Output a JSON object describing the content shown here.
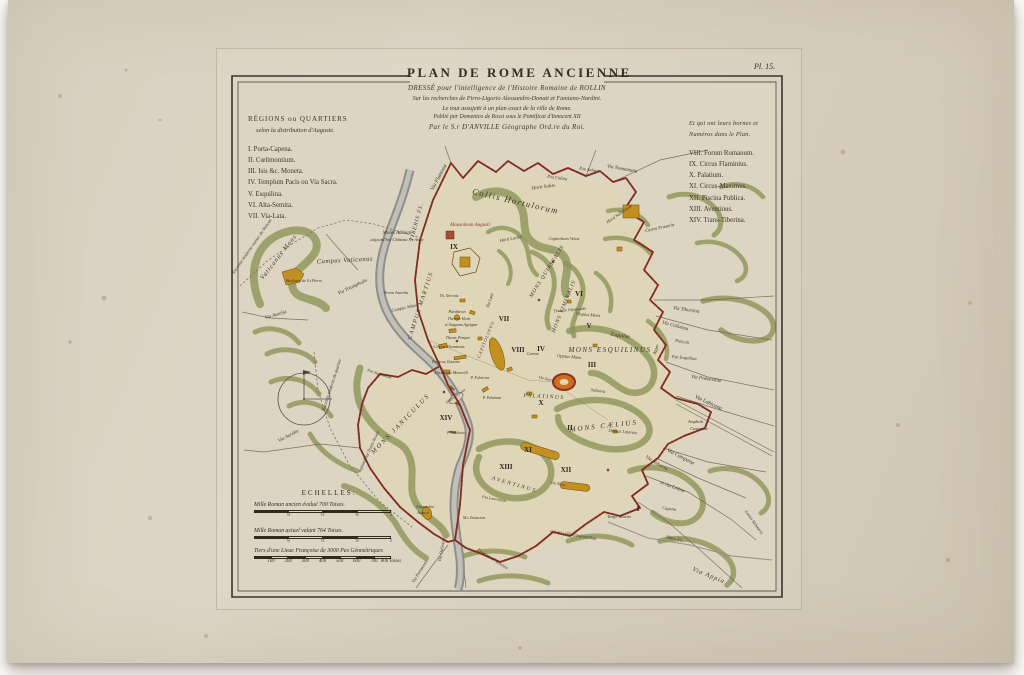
{
  "plate_label": "Pl. 15.",
  "title_block": {
    "title": "PLAN DE ROME ANCIENNE",
    "line1": "DRESSÉ pour l'intelligence de l'Histoire Romaine de ROLLIN",
    "line2": "Sur les recherches de Pirro-Ligorio Alessandro-Donati et Famiano-Nardini.",
    "line3": "Le tout assujetti à un plan exact de la ville de Rome.",
    "line4": "Publié par Domenico de Rossi sous le Pontificat d'Innocent XII",
    "line5": "Par le S.r D'ANVILLE Géographe Ord.re du Roi."
  },
  "legend_left": {
    "heading1": "RÉGIONS ou QUARTIERS",
    "heading2": "selon la distribution d'Auguste.",
    "items": [
      "I. Porta-Capena.",
      "II. Cœlimontium.",
      "III. Isis &c. Moneta.",
      "IV. Templum Pacis ou Via Sacra.",
      "V. Esquilina.",
      "VI. Alta-Semita.",
      "VII. Via-Lata."
    ]
  },
  "legend_right": {
    "heading1": "Et qui ont leurs bornes et",
    "heading2": "Numéros dans le Plan.",
    "items": [
      "VIII. Forum Romanum.",
      "IX. Circus Flaminius.",
      "X. Palatium.",
      "XI. Circus-Maximus.",
      "XII. Piscina Publica.",
      "XIII. Aventinus.",
      "XIV. Trans-Tiberina."
    ]
  },
  "scales": {
    "heading": "ECHELLES.",
    "bars": [
      {
        "label": "Mille Roman ancien évalué 700 Toises.",
        "ticks": [
          "¼",
          "½",
          "¾",
          "1"
        ]
      },
      {
        "label": "Mille Roman actuel valant 764 Toises.",
        "ticks": [
          "¼",
          "½",
          "¾",
          "1"
        ]
      },
      {
        "label": "Tiers d'une Lieue Françoise de 3000 Pas Géométriques",
        "ticks": [
          "100",
          "200",
          "300",
          "400",
          "500",
          "600",
          "700",
          "800 Toises"
        ]
      }
    ]
  },
  "colors": {
    "wall": "#832d20",
    "river": "#8f8e89",
    "hill": "#8b9454",
    "building": "#c2901f",
    "paper": "#d8d0bf",
    "ink": "#342f27"
  },
  "map_labels": [
    {
      "t": "Via Flaminia",
      "x": 432,
      "y": 178,
      "r": -62,
      "s": 5.5
    },
    {
      "t": "Horti Salus.",
      "x": 536,
      "y": 188,
      "r": -8,
      "s": 5
    },
    {
      "t": "P.ta Colina",
      "x": 549,
      "y": 179,
      "r": 8,
      "s": 4.5
    },
    {
      "t": "P.ta Salara",
      "x": 581,
      "y": 171,
      "r": 8,
      "s": 4.5
    },
    {
      "t": "Via Nomentana",
      "x": 614,
      "y": 170,
      "r": 10,
      "s": 5
    },
    {
      "t": "Collis Hortulorum",
      "x": 507,
      "y": 204,
      "r": 13,
      "s": 8.5,
      "c": "C",
      "ls": 1.5
    },
    {
      "t": "Mausoleum Augusti",
      "x": 462,
      "y": 226,
      "r": 0,
      "s": 5,
      "c": "red"
    },
    {
      "t": "IX",
      "x": 446,
      "y": 249,
      "s": 7,
      "c": "n"
    },
    {
      "t": "Moles Adriani",
      "x": 389,
      "y": 234,
      "s": 5
    },
    {
      "t": "aujourd'hui Château S.t Ange",
      "x": 389,
      "y": 241,
      "s": 4.5
    },
    {
      "t": "Vaticanus Mons",
      "x": 272,
      "y": 258,
      "r": -52,
      "s": 6.5,
      "c": "C",
      "ls": 1
    },
    {
      "t": "Campus Vaticanus",
      "x": 337,
      "y": 262,
      "r": -3,
      "s": 6.5,
      "c": "C",
      "ls": 0.5
    },
    {
      "t": "Enceinte moderne autour du Vatican",
      "x": 245,
      "y": 247,
      "r": -55,
      "s": 4.5
    },
    {
      "t": "Basilique de S.t Pierre",
      "x": 296,
      "y": 282,
      "r": 0,
      "s": 4
    },
    {
      "t": "Via Triumphalis",
      "x": 345,
      "y": 288,
      "r": -25,
      "s": 5
    },
    {
      "t": "Porta Aurelia",
      "x": 388,
      "y": 294,
      "s": 4.5
    },
    {
      "t": "Campus Minor",
      "x": 397,
      "y": 309,
      "r": -12,
      "s": 4.5
    },
    {
      "t": "CAMPUS MARTIUS",
      "x": 414,
      "y": 306,
      "r": -72,
      "s": 6,
      "c": "C",
      "ls": 1.5
    },
    {
      "t": "TIBERIS FL.",
      "x": 410,
      "y": 222,
      "r": -75,
      "s": 5.5,
      "c": "C",
      "ls": 1
    },
    {
      "t": "Via Aurelia",
      "x": 268,
      "y": 316,
      "r": -16,
      "s": 5
    },
    {
      "t": "Via Aurelia",
      "x": 281,
      "y": 437,
      "r": -28,
      "s": 5
    },
    {
      "t": "Enceinte moderne du quartier",
      "x": 325,
      "y": 385,
      "r": -72,
      "s": 4.5
    },
    {
      "t": "aujourd'hui Trans-Tevere",
      "x": 362,
      "y": 452,
      "r": -65,
      "s": 4.5
    },
    {
      "t": "MONS JANICULUS",
      "x": 394,
      "y": 425,
      "r": -46,
      "s": 6.5,
      "c": "C",
      "ls": 2
    },
    {
      "t": "XIV",
      "x": 438,
      "y": 420,
      "s": 7,
      "c": "n"
    },
    {
      "t": "Horti Lucilli",
      "x": 503,
      "y": 240,
      "r": -10,
      "s": 4.5
    },
    {
      "t": "Capitolium Vetus",
      "x": 556,
      "y": 240,
      "r": 0,
      "s": 4.5
    },
    {
      "t": "Horti Sallustiani",
      "x": 612,
      "y": 215,
      "r": -35,
      "s": 4.5
    },
    {
      "t": "Castra Prætoria",
      "x": 652,
      "y": 229,
      "r": -12,
      "s": 4.5
    },
    {
      "t": "MONS QUIRINALIS",
      "x": 540,
      "y": 272,
      "r": -58,
      "s": 5.5,
      "c": "C",
      "ls": 1
    },
    {
      "t": "MONS VIMINALIS",
      "x": 557,
      "y": 307,
      "r": -68,
      "s": 5.5,
      "c": "C",
      "ls": 1
    },
    {
      "t": "MONS ESQUILINUS",
      "x": 602,
      "y": 352,
      "r": 0,
      "s": 7,
      "c": "C",
      "ls": 1.5
    },
    {
      "t": "Esquiliæ",
      "x": 612,
      "y": 337,
      "r": 8,
      "s": 5.5
    },
    {
      "t": "VII",
      "x": 496,
      "y": 321,
      "s": 7,
      "c": "n"
    },
    {
      "t": "VIII",
      "x": 510,
      "y": 352,
      "s": 7,
      "c": "n"
    },
    {
      "t": "IV",
      "x": 533,
      "y": 351,
      "s": 7,
      "c": "n"
    },
    {
      "t": "V",
      "x": 581,
      "y": 328,
      "s": 7,
      "c": "n"
    },
    {
      "t": "III",
      "x": 584,
      "y": 367,
      "s": 7,
      "c": "n"
    },
    {
      "t": "VI",
      "x": 571,
      "y": 296,
      "s": 7,
      "c": "n"
    },
    {
      "t": "Thermæ Olympiadis",
      "x": 562,
      "y": 311,
      "r": -5,
      "s": 4
    },
    {
      "t": "Cispius Mons",
      "x": 580,
      "y": 316,
      "r": 5,
      "s": 4.5
    },
    {
      "t": "Oppius Mons",
      "x": 561,
      "y": 358,
      "r": 5,
      "s": 4.5
    },
    {
      "t": "Carinæ",
      "x": 525,
      "y": 355,
      "r": 0,
      "s": 4
    },
    {
      "t": "MONS CÆLIUS",
      "x": 596,
      "y": 428,
      "r": -6,
      "s": 7,
      "c": "C",
      "ls": 2
    },
    {
      "t": "II",
      "x": 562,
      "y": 430,
      "s": 7,
      "c": "n"
    },
    {
      "t": "Domus Lateran.",
      "x": 615,
      "y": 433,
      "r": 5,
      "s": 4.5
    },
    {
      "t": "Amphith.",
      "x": 688,
      "y": 423,
      "s": 4.5
    },
    {
      "t": "Castrense",
      "x": 691,
      "y": 430,
      "s": 4.5
    },
    {
      "t": "Via Labicana",
      "x": 700,
      "y": 404,
      "r": 25,
      "s": 5.5
    },
    {
      "t": "Via Campana",
      "x": 672,
      "y": 458,
      "r": 27,
      "s": 5.5
    },
    {
      "t": "Via Asinaria",
      "x": 648,
      "y": 464,
      "r": 30,
      "s": 5
    },
    {
      "t": "et via Latina",
      "x": 664,
      "y": 488,
      "r": 20,
      "s": 5
    },
    {
      "t": "I",
      "x": 630,
      "y": 511,
      "s": 7,
      "c": "n"
    },
    {
      "t": "Capena",
      "x": 661,
      "y": 510,
      "r": 8,
      "s": 4.5
    },
    {
      "t": "Temp. Martis",
      "x": 611,
      "y": 518,
      "r": 0,
      "s": 4.5
    },
    {
      "t": "Almo Fl.",
      "x": 666,
      "y": 540,
      "r": 12,
      "s": 5
    },
    {
      "t": "Via Appia",
      "x": 700,
      "y": 577,
      "r": 22,
      "s": 6.5,
      "c": "C",
      "ls": 1
    },
    {
      "t": "Lacus Salutaris",
      "x": 745,
      "y": 523,
      "r": 55,
      "s": 4.5
    },
    {
      "t": "Via Tiburtina",
      "x": 678,
      "y": 311,
      "r": 8,
      "s": 5
    },
    {
      "t": "Via Collatina",
      "x": 667,
      "y": 327,
      "r": 15,
      "s": 5
    },
    {
      "t": "Puticoli",
      "x": 674,
      "y": 343,
      "r": 10,
      "s": 4.5
    },
    {
      "t": "P.ta Esquilina",
      "x": 676,
      "y": 359,
      "r": 5,
      "s": 4.5
    },
    {
      "t": "Via Prænestina",
      "x": 698,
      "y": 380,
      "r": 8,
      "s": 5
    },
    {
      "t": "Agger",
      "x": 649,
      "y": 350,
      "r": -70,
      "s": 4.5
    },
    {
      "t": "PALATINUS",
      "x": 536,
      "y": 398,
      "r": 3,
      "s": 5.5,
      "c": "C",
      "ls": 1.5
    },
    {
      "t": "X",
      "x": 533,
      "y": 405,
      "s": 7,
      "c": "n"
    },
    {
      "t": "XI",
      "x": 520,
      "y": 452,
      "s": 7,
      "c": "n"
    },
    {
      "t": "XII",
      "x": 558,
      "y": 472,
      "s": 7,
      "c": "n"
    },
    {
      "t": "XIII",
      "x": 498,
      "y": 469,
      "s": 7,
      "c": "n"
    },
    {
      "t": "Circus Flaminius",
      "x": 441,
      "y": 348,
      "r": 0,
      "s": 4.5
    },
    {
      "t": "Porticus Octaviæ",
      "x": 438,
      "y": 363,
      "r": 0,
      "s": 4
    },
    {
      "t": "Theatrum Marcelli",
      "x": 443,
      "y": 374,
      "r": 0,
      "s": 4.5
    },
    {
      "t": "P. Fabricius",
      "x": 472,
      "y": 379,
      "r": 0,
      "s": 3.8
    },
    {
      "t": "Insula Tiberina",
      "x": 448,
      "y": 397,
      "r": -35,
      "s": 3.8
    },
    {
      "t": "P. Palatinus",
      "x": 484,
      "y": 399,
      "r": 0,
      "s": 3.8
    },
    {
      "t": "P. Sublicius",
      "x": 448,
      "y": 434,
      "r": 0,
      "s": 3.8
    },
    {
      "t": "Pantheon",
      "x": 449,
      "y": 313,
      "r": 0,
      "s": 4.5
    },
    {
      "t": "Thermæ Horti",
      "x": 451,
      "y": 320,
      "r": 0,
      "s": 4
    },
    {
      "t": "et Stagnum Agrippæ",
      "x": 453,
      "y": 326,
      "r": 0,
      "s": 4
    },
    {
      "t": "Th. Neronis",
      "x": 441,
      "y": 297,
      "r": 0,
      "s": 4
    },
    {
      "t": "Theatr. Pompei",
      "x": 450,
      "y": 339,
      "r": 0,
      "s": 4
    },
    {
      "t": "Via Lata",
      "x": 483,
      "y": 301,
      "r": -72,
      "s": 4.5
    },
    {
      "t": "Suburra",
      "x": 590,
      "y": 392,
      "r": 8,
      "s": 4.5
    },
    {
      "t": "Via Sacra",
      "x": 538,
      "y": 380,
      "r": 12,
      "s": 4
    },
    {
      "t": "CAPITOLINUS",
      "x": 479,
      "y": 340,
      "r": -68,
      "s": 4.5,
      "c": "C",
      "ls": 1
    },
    {
      "t": "AVENTINUS",
      "x": 506,
      "y": 486,
      "r": 16,
      "s": 5.5,
      "c": "C",
      "ls": 2
    },
    {
      "t": "M.s Testaceus",
      "x": 466,
      "y": 519,
      "r": 0,
      "s": 4
    },
    {
      "t": "P.ta Laurentina",
      "x": 486,
      "y": 500,
      "r": 10,
      "s": 4
    },
    {
      "t": "Enceinte d'Aurelien",
      "x": 484,
      "y": 560,
      "r": 33,
      "s": 4.5
    },
    {
      "t": "qui est celle d'aujourd'hui",
      "x": 565,
      "y": 536,
      "r": 10,
      "s": 4.5
    },
    {
      "t": "Naumachia",
      "x": 417,
      "y": 508,
      "r": 0,
      "s": 3.8
    },
    {
      "t": "Augusti",
      "x": 415,
      "y": 514,
      "r": 0,
      "s": 3.8
    },
    {
      "t": "Via Ostiensis",
      "x": 435,
      "y": 550,
      "r": -80,
      "s": 4.5
    },
    {
      "t": "Via Portuensis",
      "x": 413,
      "y": 572,
      "r": -58,
      "s": 4.5
    },
    {
      "t": "P.ta Septimiana",
      "x": 371,
      "y": 375,
      "r": 18,
      "s": 4
    },
    {
      "t": "Via Nova",
      "x": 550,
      "y": 485,
      "r": 10,
      "s": 4
    }
  ]
}
